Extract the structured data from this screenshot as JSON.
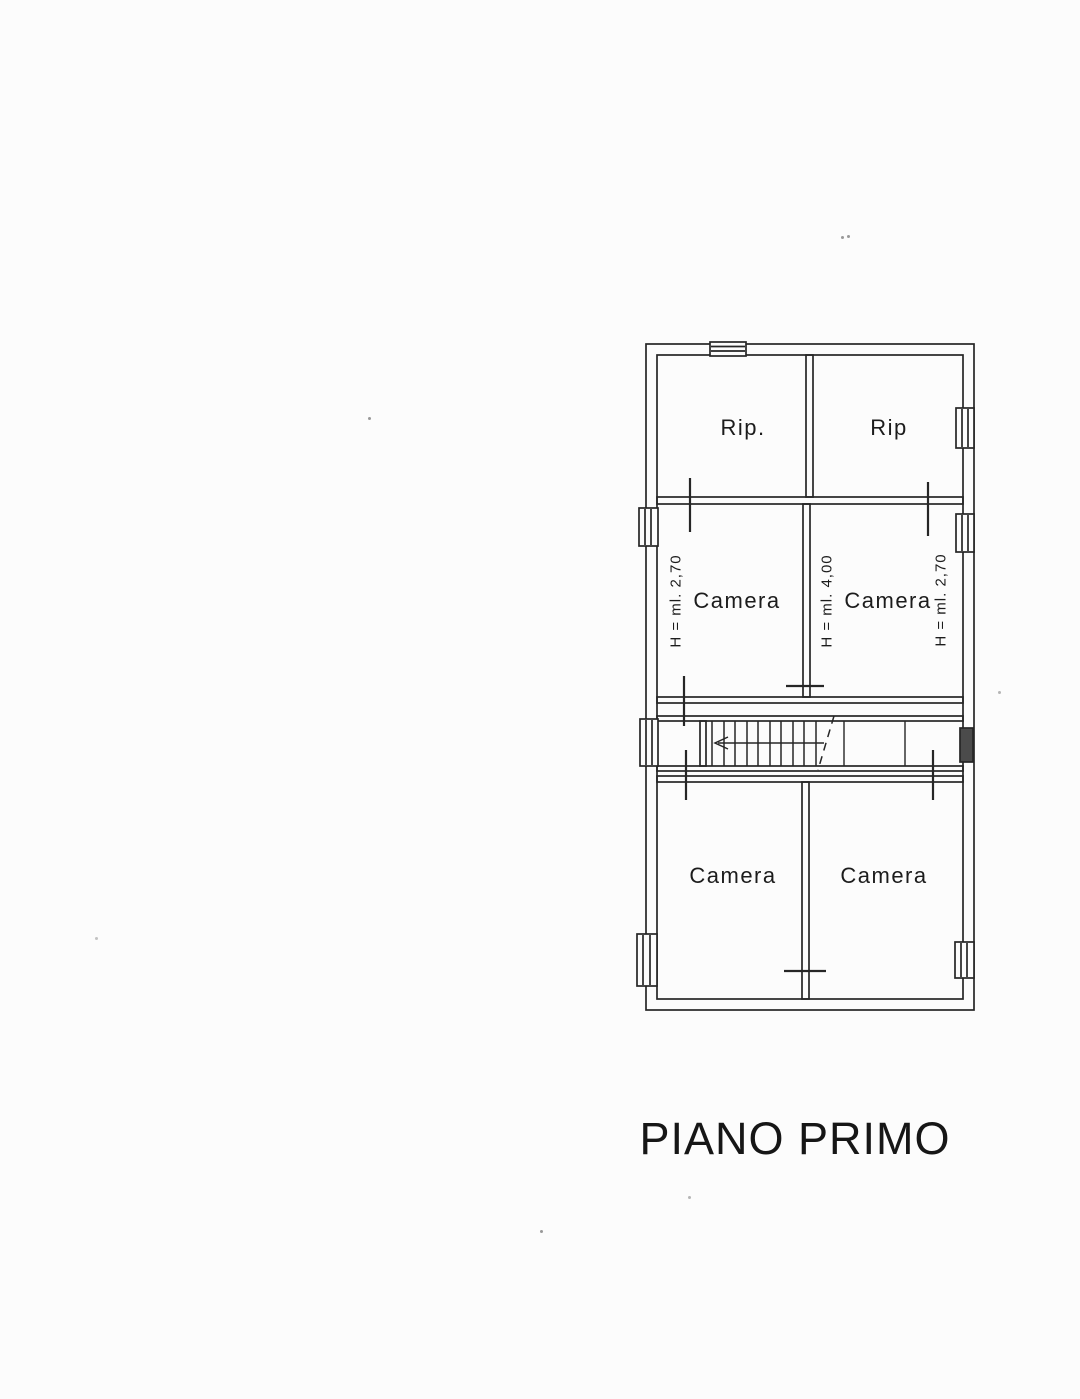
{
  "page": {
    "background": "#fcfcfc",
    "ink": "#222222",
    "title": "PIANO PRIMO"
  },
  "plan": {
    "rooms": [
      {
        "label": "Rip."
      },
      {
        "label": "Rip"
      },
      {
        "label": "Camera"
      },
      {
        "label": "Camera"
      },
      {
        "label": "Camera"
      },
      {
        "label": "Camera"
      }
    ],
    "height_labels": [
      {
        "text": "H = ml. 2,70"
      },
      {
        "text": "H = ml. 4,00"
      },
      {
        "text": "H = ml. 2,70"
      }
    ]
  }
}
